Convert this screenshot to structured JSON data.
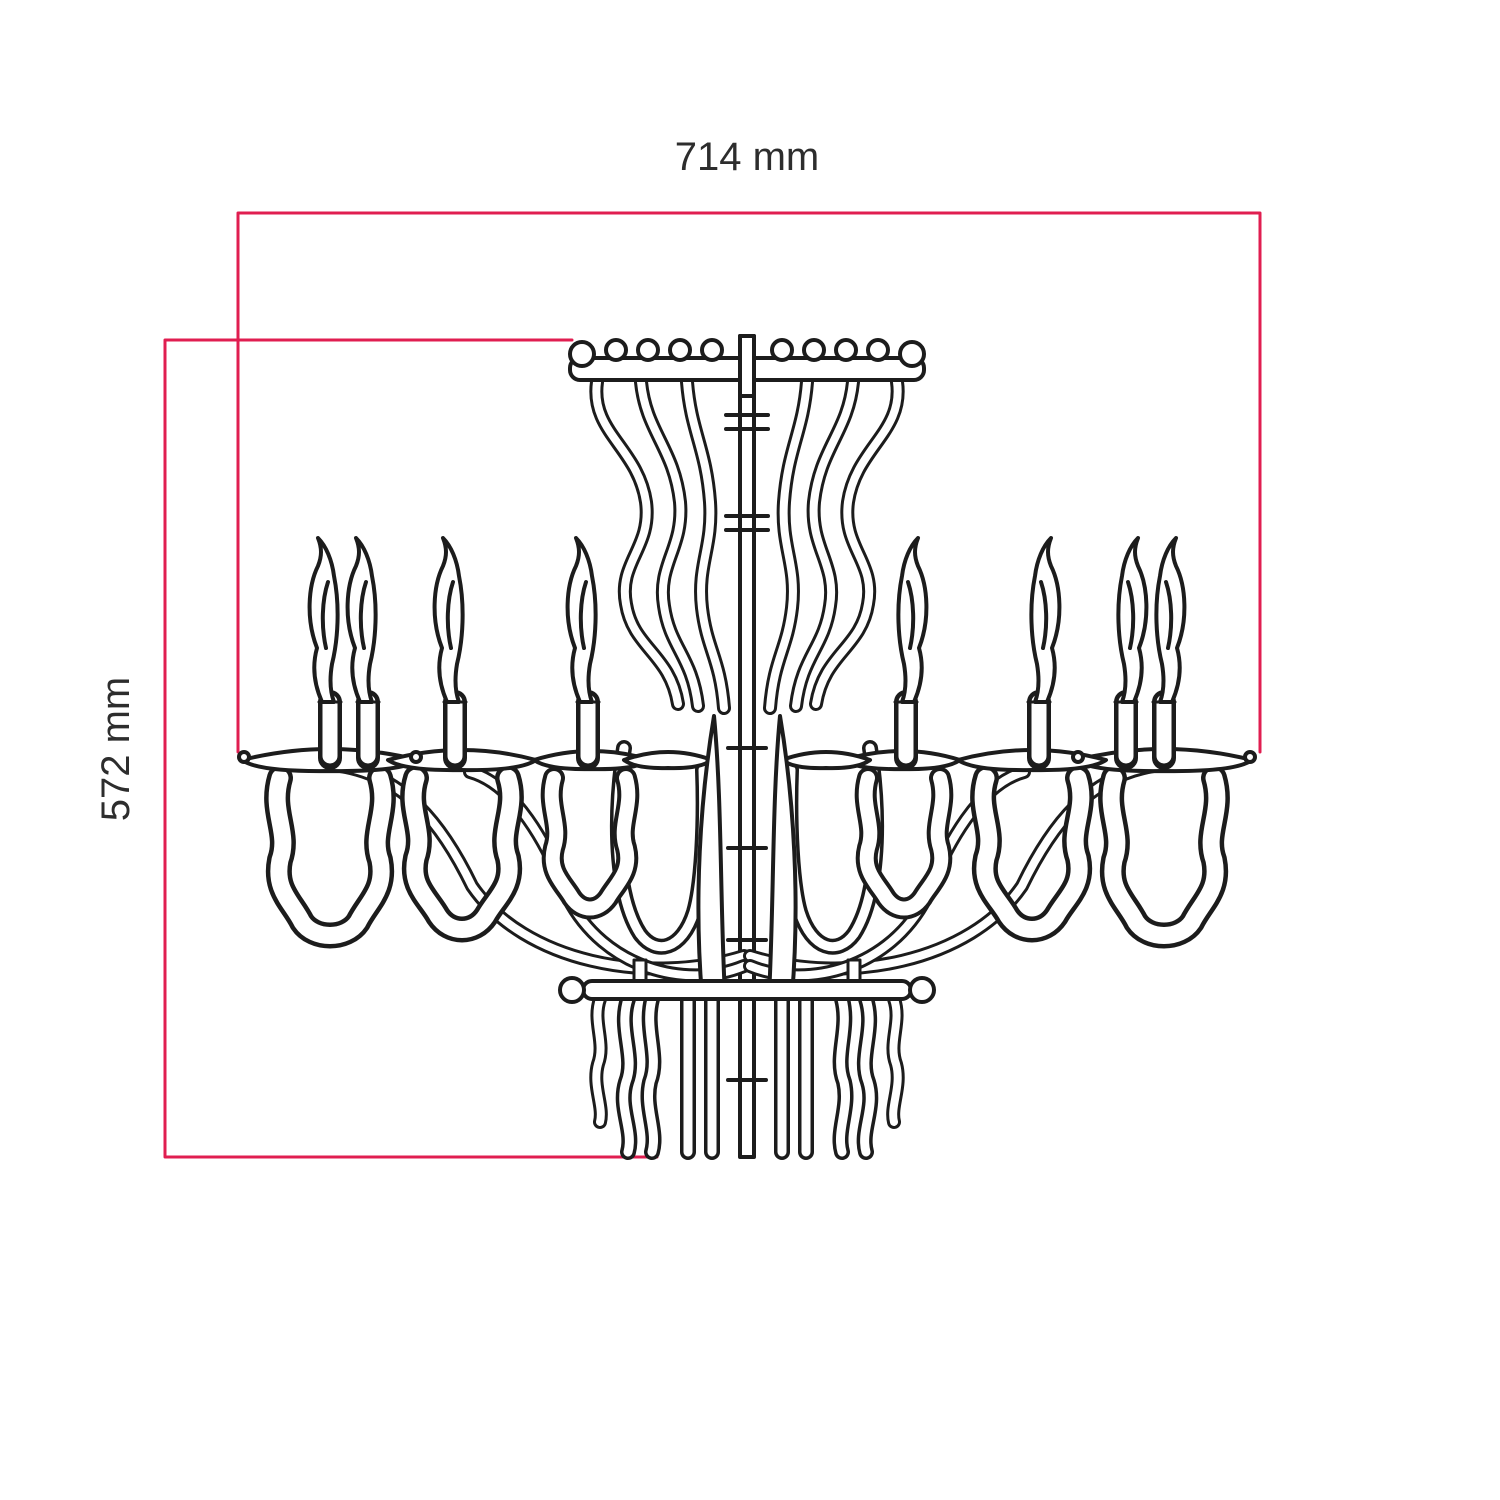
{
  "drawing": {
    "subject_icon": "chandelier-front-elevation-line-drawing",
    "style": "technical dimensioned outline drawing"
  },
  "dimensions": {
    "width": {
      "label": "714 mm"
    },
    "height": {
      "label": "572 mm"
    }
  },
  "colors": {
    "dimension_line": "#e01e50",
    "drawing_ink": "#1c1c1c",
    "label_text": "#2d2d2d",
    "background": "#ffffff"
  }
}
